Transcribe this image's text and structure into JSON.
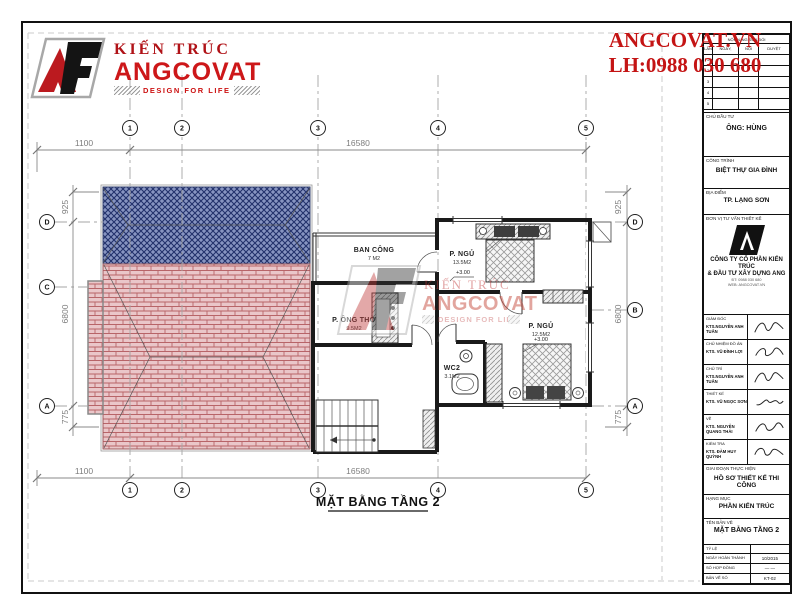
{
  "brand": {
    "logo_title": "KIẾN TRÚC",
    "logo_name": "ANGCOVAT",
    "logo_tagline": "DESIGN FOR LIFE"
  },
  "contact": {
    "website": "ANGCOVAT.VN",
    "phone": "LH:0988 030 680"
  },
  "titleblock": {
    "revision": {
      "title": "NỘI DUNG SỬA ĐỔI",
      "cols": [
        "LẦN",
        "NGÀY, THÁNG",
        "NỘI DUNG",
        "DUYỆT"
      ],
      "rows": [
        "1",
        "2",
        "3",
        "4",
        "5"
      ]
    },
    "owner_label": "CHỦ ĐẦU TƯ",
    "owner_value": "ÔNG: HÙNG",
    "project_label": "CÔNG TRÌNH",
    "project_value": "BIỆT THỰ GIA ĐÌNH",
    "location_label": "ĐỊA ĐIỂM",
    "location_value": "TP. LẠNG SƠN",
    "consultant_label": "ĐƠN VỊ TƯ VẤN THIẾT KẾ",
    "company_line1": "CÔNG TY CỔ PHẦN KIẾN TRÚC",
    "company_line2": "& ĐẦU TƯ XÂY DỰNG ANG",
    "addr_line1": "ĐT: 0988 030 680",
    "addr_line2": "WEB: ANGCOVAT.VN",
    "signatures": [
      {
        "role": "GIÁM ĐỐC",
        "name": "KTS.NGUYỄN ANH TUẤN"
      },
      {
        "role": "CHỦ NHIỆM ĐỒ ÁN",
        "name": "KTS. VŨ ĐÌNH LỢI"
      },
      {
        "role": "CHỦ TRÌ",
        "name": "KTS.NGUYỄN ANH TUẤN"
      },
      {
        "role": "THIẾT KẾ",
        "name": "KTS. VŨ NGỌC SƠN"
      },
      {
        "role": "VẼ",
        "name": "KTS. NGUYỄN QUANG THÁI"
      },
      {
        "role": "KIỂM TRA",
        "name": "KTS. ĐÀM HUY QUỲNH"
      }
    ],
    "stage_label": "GIAI ĐOẠN THỰC HIỆN",
    "stage_value": "HỒ SƠ THIẾT KẾ THI CÔNG",
    "category_label": "HẠNG MỤC",
    "category_value": "PHẦN KIẾN TRÚC",
    "drawing_label": "TÊN BẢN VẼ",
    "drawing_value": "MẶT BẰNG TẦNG 2",
    "scale_label": "TỶ LỆ",
    "scale_value": "",
    "date_label": "NGÀY HOÀN THÀNH",
    "date_value": "10/2015",
    "contract_label": "SỐ HỢP ĐỒNG",
    "contract_value": "— —",
    "number_label": "BẢN VẼ SỐ",
    "number_value": "KT-02"
  },
  "plan": {
    "title": "MẶT BẰNG TẦNG 2",
    "grid_cols": [
      "1",
      "2",
      "3",
      "4",
      "5"
    ],
    "grid_rows_left": [
      "D",
      "C",
      "A"
    ],
    "grid_rows_right": [
      "D",
      "B",
      "A"
    ],
    "dims": {
      "top_left": "1100",
      "top_span": "16580",
      "bottom_left": "1100",
      "bottom_span": "16580",
      "left_top": "925",
      "left_mid": "6800",
      "left_bottom": "775",
      "right_top": "925",
      "right_mid": "6800",
      "right_bottom": "775"
    },
    "rooms": {
      "balcony": {
        "name": "BAN CÔNG",
        "area": "7 M2"
      },
      "bed1": {
        "name": "P. NGỦ",
        "area": "13.5M2",
        "level": "+3.00"
      },
      "altar": {
        "name": "P. ÔNG THỜ",
        "area": "9.5M2"
      },
      "wc": {
        "name": "WC2",
        "area": "3.1M2"
      },
      "bed2": {
        "name": "P. NGỦ",
        "area": "12.5M2",
        "level": "+3.00"
      }
    },
    "watermark": {
      "line1": "KIẾN TRÚC",
      "line2": "ANGCOVAT",
      "line3": "DESIGN FOR LIFE"
    }
  },
  "colors": {
    "accent_red": "#c41414",
    "roof_blue": "#8794c1",
    "roof_blue_line": "#22316b",
    "roof_pink": "#eac6c9",
    "roof_pink_line": "#b86468",
    "dim_gray": "#8a8a8a"
  }
}
